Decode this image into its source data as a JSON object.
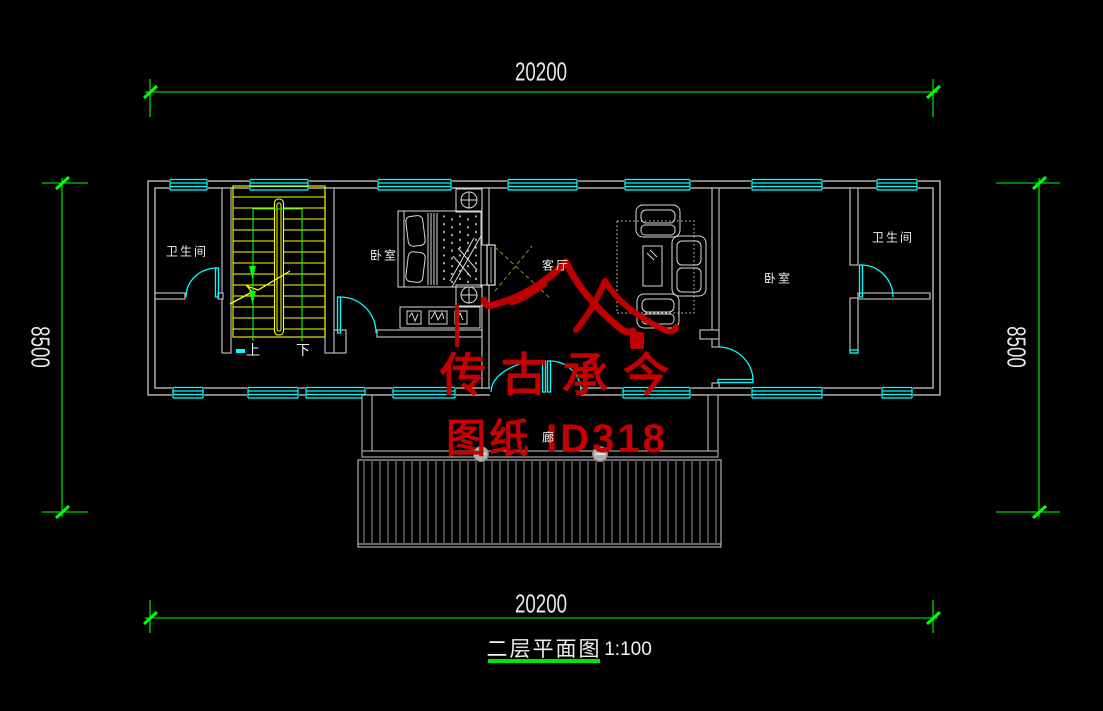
{
  "dimensions": {
    "top": "20200",
    "bottom": "20200",
    "left": "8500",
    "right": "8500"
  },
  "title": {
    "name": "二层平面图",
    "scale": "1:100"
  },
  "labels": {
    "bathroom_left": "卫生间",
    "bedroom_left": "卧室",
    "living_room": "客厅",
    "bedroom_right": "卧室",
    "bathroom_right": "卫生间",
    "corridor": "廊",
    "stair_up": "上",
    "stair_down": "下"
  },
  "watermark": {
    "line1": "传古承今",
    "line2": "图纸 ID318"
  },
  "colors": {
    "background": "#000000",
    "wall": "#c8c8c8",
    "window": "#00ffff",
    "dimension_line": "#00ff00",
    "stair": "#ffff00",
    "furniture": "#d9d9d9",
    "watermark": "#c40000",
    "text": "#e9e9e9"
  }
}
